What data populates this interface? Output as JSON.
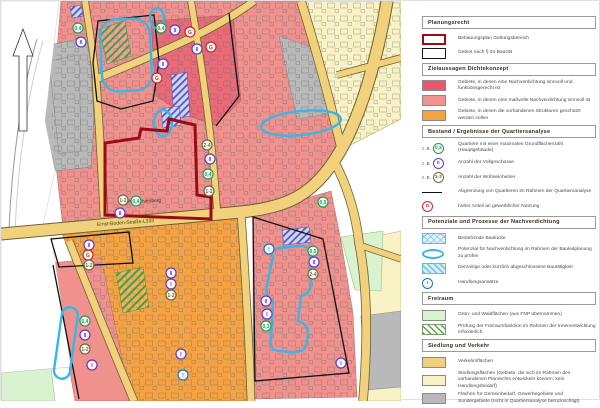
{
  "map": {
    "street_labels": [
      {
        "text": "Ernst-Boden-Straße-L333",
        "x": 96,
        "y": 225,
        "rotate": -4
      },
      {
        "text": "Am Hövenberg",
        "x": 127,
        "y": 202,
        "rotate": -2
      }
    ],
    "badge_colors": {
      "grz": "#1f9d55",
      "floors": "#5f3dc4",
      "units": "#6d6a3f",
      "gewerbe": "#c92a2a",
      "action": "#1971c2"
    },
    "badges": [
      {
        "x": 77,
        "y": 27,
        "t": "grz",
        "s": "0,4"
      },
      {
        "x": 80,
        "y": 41,
        "t": "floors",
        "s": "II"
      },
      {
        "x": 160,
        "y": 27,
        "t": "grz",
        "s": "0,4"
      },
      {
        "x": 174,
        "y": 29,
        "t": "floors",
        "s": "II"
      },
      {
        "x": 189,
        "y": 31,
        "t": "gewerbe",
        "s": "G"
      },
      {
        "x": 196,
        "y": 48,
        "t": "floors",
        "s": "II"
      },
      {
        "x": 210,
        "y": 46,
        "t": "gewerbe",
        "s": "G"
      },
      {
        "x": 162,
        "y": 63,
        "t": "floors",
        "s": "II"
      },
      {
        "x": 156,
        "y": 77,
        "t": "gewerbe",
        "s": "G"
      },
      {
        "x": 206,
        "y": 144,
        "t": "units",
        "s": "2-4"
      },
      {
        "x": 209,
        "y": 158,
        "t": "floors",
        "s": "II"
      },
      {
        "x": 207,
        "y": 173,
        "t": "grz",
        "s": "0,4"
      },
      {
        "x": 208,
        "y": 190,
        "t": "units",
        "s": "1-2"
      },
      {
        "x": 122,
        "y": 199,
        "t": "units",
        "s": "1-2"
      },
      {
        "x": 135,
        "y": 200,
        "t": "grz",
        "s": "0,4"
      },
      {
        "x": 119,
        "y": 212,
        "t": "floors",
        "s": "II"
      },
      {
        "x": 322,
        "y": 201,
        "t": "grz",
        "s": "0,5"
      },
      {
        "x": 88,
        "y": 244,
        "t": "floors",
        "s": "II"
      },
      {
        "x": 87,
        "y": 254,
        "t": "gewerbe",
        "s": "G"
      },
      {
        "x": 88,
        "y": 264,
        "t": "units",
        "s": "1-2"
      },
      {
        "x": 170,
        "y": 272,
        "t": "floors",
        "s": "II"
      },
      {
        "x": 170,
        "y": 283,
        "t": "floors",
        "s": "I"
      },
      {
        "x": 170,
        "y": 294,
        "t": "units",
        "s": "1-2"
      },
      {
        "x": 84,
        "y": 320,
        "t": "grz",
        "s": "0,4"
      },
      {
        "x": 84,
        "y": 334,
        "t": "floors",
        "s": "II"
      },
      {
        "x": 84,
        "y": 348,
        "t": "units",
        "s": "1-2"
      },
      {
        "x": 91,
        "y": 364,
        "t": "floors",
        "s": "I"
      },
      {
        "x": 180,
        "y": 353,
        "t": "floors",
        "s": "I"
      },
      {
        "x": 182,
        "y": 374,
        "t": "action",
        "s": "!"
      },
      {
        "x": 268,
        "y": 248,
        "t": "action",
        "s": "!"
      },
      {
        "x": 312,
        "y": 250,
        "t": "grz",
        "s": "0,5"
      },
      {
        "x": 313,
        "y": 261,
        "t": "floors",
        "s": "II"
      },
      {
        "x": 312,
        "y": 273,
        "t": "units",
        "s": "2-4"
      },
      {
        "x": 265,
        "y": 300,
        "t": "floors",
        "s": "II"
      },
      {
        "x": 266,
        "y": 313,
        "t": "floors",
        "s": "I"
      },
      {
        "x": 265,
        "y": 325,
        "t": "grz",
        "s": "0,3"
      },
      {
        "x": 340,
        "y": 362,
        "t": "floors",
        "s": "I"
      }
    ]
  },
  "legend": {
    "sections": [
      {
        "header": "Planungsrecht",
        "items": [
          {
            "type": "bplan",
            "label": "Bebauungsplan Geltungsbereich"
          },
          {
            "type": "p34",
            "label": "Gebiet nach § 34 BauGB"
          }
        ]
      },
      {
        "header": "Zielaussagen Dichtekonzept",
        "items": [
          {
            "type": "fill",
            "color": "#e8576b",
            "label": "Gebiete, in denen eine Nachverdichtung sinnvoll und funktionsgerecht ist"
          },
          {
            "type": "fill",
            "color": "#f0928e",
            "label": "Gebiete, in denen eine maßvolle Nachverdichtung sinnvoll ist"
          },
          {
            "type": "fill",
            "color": "#f5a243",
            "label": "Gebiete, in denen die vorhandenen Strukturen geschützt werden sollen"
          }
        ]
      },
      {
        "header": "Bestand / Ergebnisse der Quartiersanalyse",
        "items": [
          {
            "type": "badge",
            "badge": "grz",
            "prefix": "z. B.",
            "symbol": "0,3",
            "label": "Quartiere mit einer maximalen Grundflächenzahl (Hauptgebäude)"
          },
          {
            "type": "badge",
            "badge": "floors",
            "prefix": "z. B.",
            "symbol": "II",
            "label": "Anzahl der Vollgeschosse"
          },
          {
            "type": "badge",
            "badge": "units",
            "prefix": "z. B.",
            "symbol": "1-2",
            "label": "Anzahl der Wohneinheiten"
          },
          {
            "type": "line",
            "label": "Abgrenzung von Quartieren im Rahmen der Quartiersanalyse"
          },
          {
            "type": "badge",
            "badge": "gewerbe",
            "symbol": "G",
            "label": "hoher Anteil an gewerblicher Nutzung"
          }
        ]
      },
      {
        "header": "Potenziale und Prozesse der Nachverdichtung",
        "items": [
          {
            "type": "hatch-cross-blue",
            "label": "Bestehende Baulücke"
          },
          {
            "type": "blob",
            "label": "Potenzial für Nachverdichtung im Rahmen der Bauleitplanung zu prüfen"
          },
          {
            "type": "hatch-diag-blue",
            "label": "Derzeitige oder kürzlich abgeschlossene Bautätigkeit"
          },
          {
            "type": "badge",
            "badge": "action",
            "symbol": "!",
            "label": "Handlungsansätze"
          }
        ]
      },
      {
        "header": "Freiraum",
        "items": [
          {
            "type": "fill",
            "color": "#d9f2cf",
            "label": "Grün- und Waldflächen (aus FNP übernommen)"
          },
          {
            "type": "hatch-diag-green",
            "label": "Prüfung der Freiraumfunktion im Rahmen der Innenentwicklung erforderlich"
          }
        ]
      },
      {
        "header": "Siedlung und Verkehr",
        "items": [
          {
            "type": "fill",
            "color": "#f1d17b",
            "label": "Verkehrsflächen"
          },
          {
            "type": "fill",
            "color": "#f8f2c4",
            "label": "Siedlungsflächen (Gebiete, die sich im Rahmen des vorhandenen Planrechts entwickeln können; kein Handlungsbedarf)"
          },
          {
            "type": "fill",
            "color": "#b9b9b9",
            "label": "Flächen für Gemeinbedarf, Gewerbegebiete und Sondergebiete (nicht in Quartiersanalyse berücksichtigt)"
          }
        ]
      }
    ]
  }
}
